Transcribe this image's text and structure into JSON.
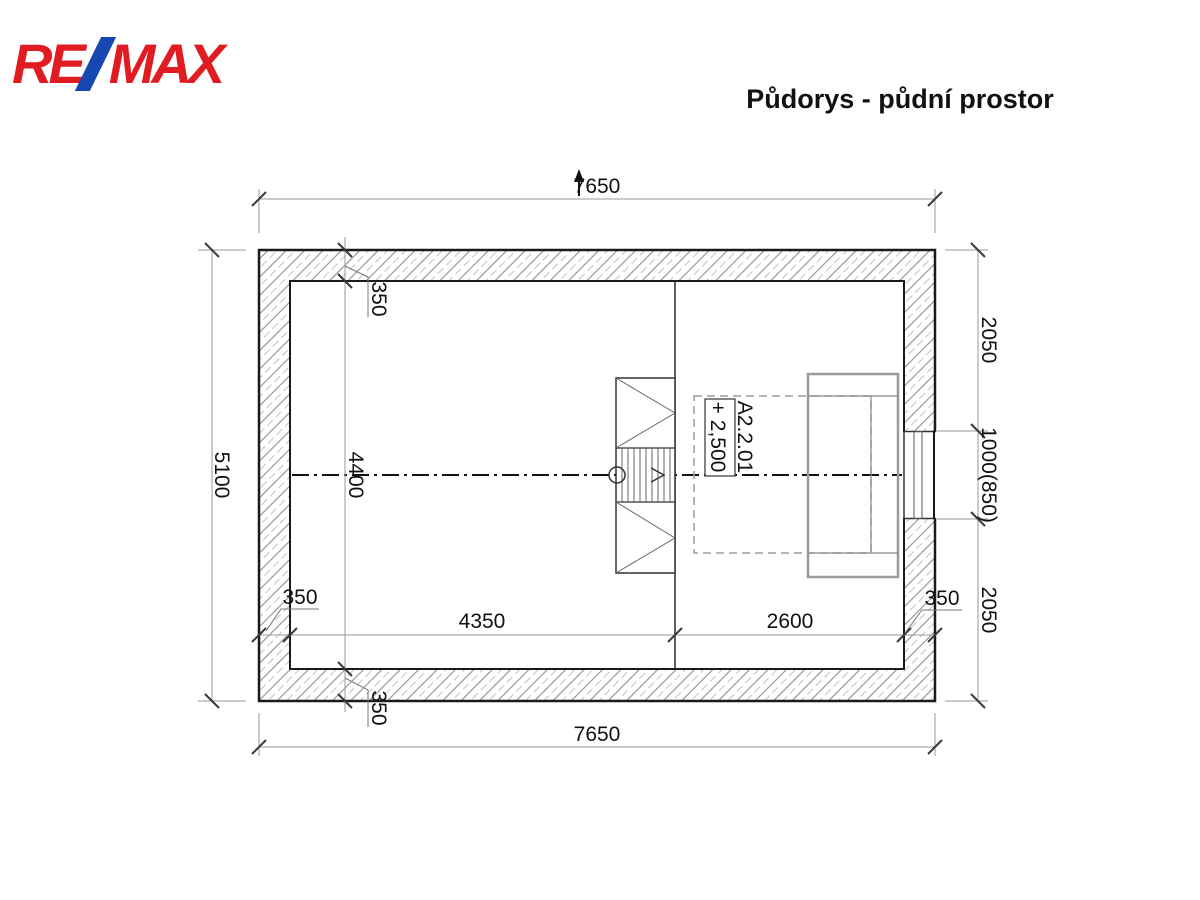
{
  "header": {
    "logo_re": "RE",
    "logo_max": "MAX",
    "title": "Půdorys - půdní prostor"
  },
  "plan": {
    "labels": {
      "room": "A2.2.01",
      "level": "+ 2,500"
    },
    "dims": {
      "top_width": "7650",
      "bottom_width": "7650",
      "left_height": "5100",
      "right_top": "2050",
      "right_window": "1000(850)",
      "right_bottom": "2050",
      "inner_left_width": "4350",
      "inner_right_width": "2600",
      "inner_height": "4400",
      "wall_top": "350",
      "wall_bottom": "350",
      "wall_left": "350",
      "wall_right": "350"
    },
    "colors": {
      "logo_red": "#e11b22",
      "logo_blue": "#1747b0",
      "drawing_black": "#1a1a1a",
      "dim_gray": "#9a9a9a"
    }
  }
}
